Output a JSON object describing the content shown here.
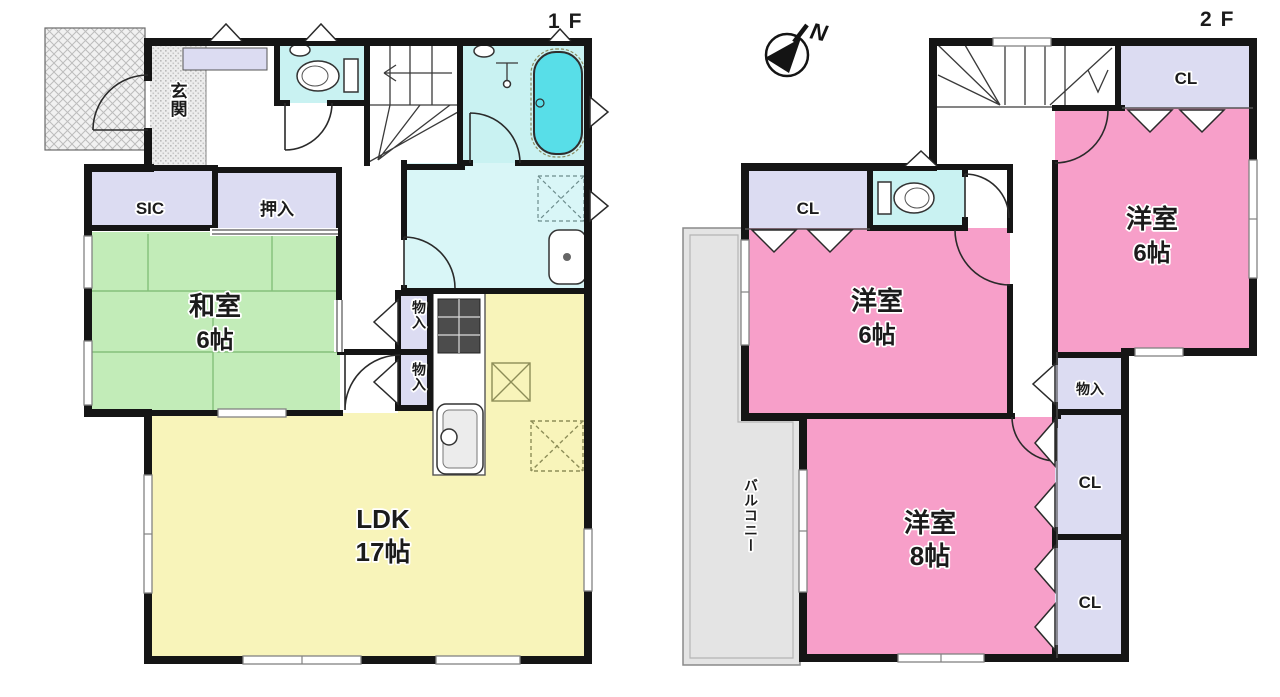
{
  "titles": {
    "floor1": "1F",
    "floor2": "2F"
  },
  "compass": {
    "north": "N"
  },
  "floor1": {
    "entrance": "玄関",
    "sic": "SIC",
    "oshiire": "押入",
    "washitsu": {
      "name": "和室",
      "size": "6帖"
    },
    "storage1": "物入",
    "storage2": "物入",
    "ldk": {
      "name": "LDK",
      "size": "17帖"
    }
  },
  "floor2": {
    "closet_hall": "CL",
    "west_room_left": {
      "name": "洋室",
      "size": "6帖"
    },
    "closet_top_right": "CL",
    "west_room_right": {
      "name": "洋室",
      "size": "6帖"
    },
    "west_room_large": {
      "name": "洋室",
      "size": "8帖"
    },
    "storage": "物入",
    "closet_mid": "CL",
    "closet_bottom": "CL",
    "balcony": "バルコニー"
  },
  "colors": {
    "wall": "#151515",
    "tatami_green": "#c2ecb8",
    "ldk_yellow": "#f8f4ba",
    "western_pink": "#f79fc9",
    "closet_lavender": "#dcdcf2",
    "sanitary_cyan": "#c9f2f2",
    "washroom_cyan": "#d9f6f7",
    "bathtub_cyan": "#58dee8",
    "balcony_gray": "#e4e4e4"
  }
}
